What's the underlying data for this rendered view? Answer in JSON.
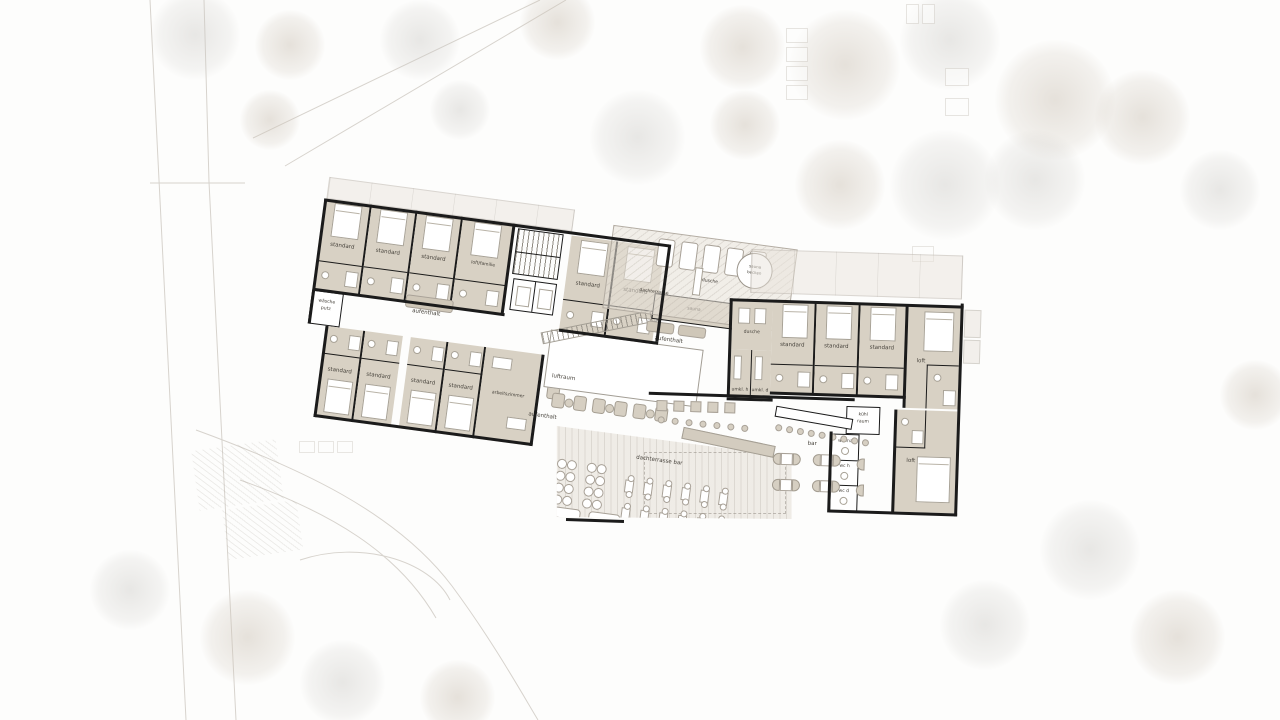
{
  "colors": {
    "wall": "#1b1b1b",
    "room_fill": "#d8d1c4",
    "terrace_fill": "#e4ded4",
    "furniture_accent": "#cfc7b8"
  },
  "plan": {
    "wing_left": {
      "rooms_top": [
        {
          "label": "standard"
        },
        {
          "label": "standard"
        },
        {
          "label": "standard"
        },
        {
          "label": "loft/familie"
        }
      ],
      "utility": {
        "line1": "wäsche",
        "line2": "putz"
      },
      "lounge_corridor": {
        "label": "aufenthalt"
      },
      "rooms_bottom": [
        {
          "label": "standard"
        },
        {
          "label": "standard"
        },
        {
          "label": "standard"
        },
        {
          "label": "standard"
        },
        {
          "label": "arbeitszimmer"
        }
      ]
    },
    "wing_mid": {
      "rooms": [
        {
          "label": "standard"
        },
        {
          "label": "standard"
        }
      ],
      "void": {
        "label": "luftraum"
      },
      "lounge": {
        "label": "aufenthalt"
      },
      "lounge_terrace": {
        "label": "aufenthalt"
      },
      "sauna": {
        "label": "sauna"
      },
      "roof_terrace": {
        "label": "dachterrasse"
      },
      "shower": {
        "label": "dusche"
      },
      "pool": {
        "line1": "sauna",
        "line2": "becken"
      }
    },
    "wing_right": {
      "shower": {
        "label": "dusche"
      },
      "changing_m": {
        "label": "umkl. h"
      },
      "changing_f": {
        "label": "umkl. d"
      },
      "rooms": [
        {
          "label": "standard"
        },
        {
          "label": "standard"
        },
        {
          "label": "standard"
        }
      ],
      "loft_upper": {
        "label": "loft"
      },
      "loft_lower": {
        "label": "loft"
      },
      "cold_room": {
        "line1": "kühl",
        "line2": "raum"
      },
      "wc_staff": {
        "label": "wc ma"
      },
      "wc_m": {
        "label": "wc h"
      },
      "wc_f": {
        "label": "wc d"
      },
      "bar": {
        "label": "bar"
      }
    },
    "terrace_bar": {
      "label": "dachterrasse bar"
    }
  }
}
